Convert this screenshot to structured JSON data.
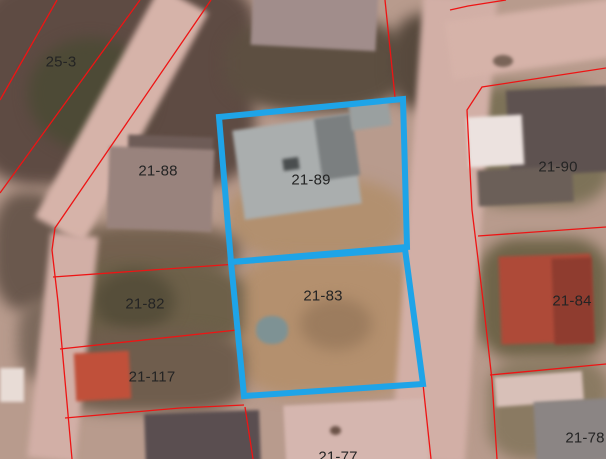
{
  "map": {
    "type": "cadastral-aerial-map",
    "colors": {
      "parcel_boundary": "#ee1414",
      "highlight": "#1ea4e8",
      "label_text": "#242424"
    },
    "highlighted_parcel_ids": [
      "21-89",
      "21-83"
    ],
    "parcels": [
      {
        "id": "25-3",
        "label": "25-3",
        "highlighted": false
      },
      {
        "id": "21-88",
        "label": "21-88",
        "highlighted": false
      },
      {
        "id": "21-89",
        "label": "21-89",
        "highlighted": true
      },
      {
        "id": "21-90",
        "label": "21-90",
        "highlighted": false
      },
      {
        "id": "21-82",
        "label": "21-82",
        "highlighted": false
      },
      {
        "id": "21-83",
        "label": "21-83",
        "highlighted": true
      },
      {
        "id": "21-84",
        "label": "21-84",
        "highlighted": false
      },
      {
        "id": "21-117",
        "label": "21-117",
        "highlighted": false
      },
      {
        "id": "21-78",
        "label": "21-78",
        "highlighted": false
      },
      {
        "id": "21-77",
        "label": "21-77",
        "highlighted": false
      }
    ]
  }
}
